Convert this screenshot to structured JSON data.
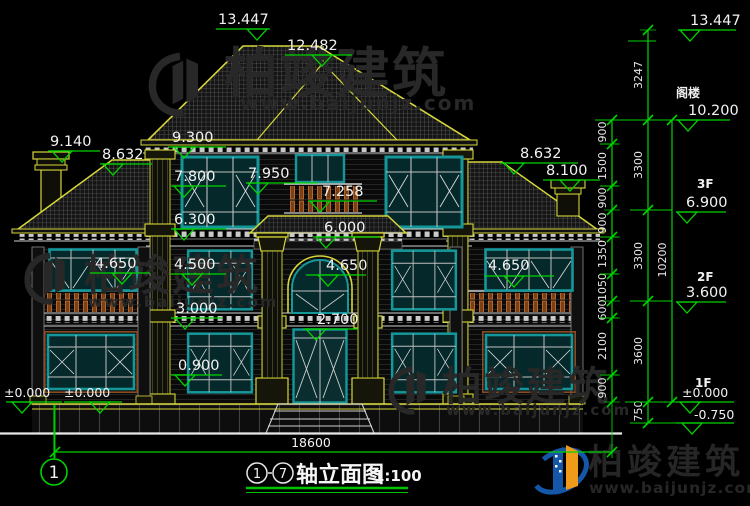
{
  "facade_marks": {
    "ridge": "13.447",
    "ridge_secondary": "12.482",
    "chimney": "9.140",
    "left_eave": "8.632",
    "left_column": [
      "9.300",
      "7.800",
      "6.300",
      "4.500",
      "3.000",
      "0.900"
    ],
    "left_wing_balcony": "4.650",
    "ground": [
      "±0.000",
      "±0.000"
    ],
    "center_column": [
      "7.950",
      "7.258",
      "6.000",
      "4.650",
      "2.700"
    ],
    "right_column": [
      "8.632",
      "8.100",
      "4.650"
    ]
  },
  "right_panel": {
    "top_elevation": "13.447",
    "attic_label": "阁楼",
    "attic_elevation": "10.200",
    "floor3_label": "3F",
    "floor3_elevation": "6.900",
    "floor2_label": "2F",
    "floor2_elevation": "3.600",
    "floor1_label": "1F",
    "floor1_elevation": "±0.000",
    "basement_elevation": "-0.750",
    "segment_dims": [
      "900",
      "1500",
      "900",
      "900",
      "1350",
      "1050",
      "600",
      "2100",
      "900"
    ],
    "floor_dims": [
      "3247",
      "3300",
      "3300",
      "3600",
      "750"
    ],
    "total_height": "10200"
  },
  "bottom": {
    "overall_width": "18600",
    "axis_bubble": "1",
    "title": {
      "axis_start": "1",
      "axis_end": "7",
      "name": "轴立面图",
      "scale": "1:100"
    }
  },
  "brand": {
    "company": "柏竣建筑",
    "website": "www.baijunjz.com"
  }
}
